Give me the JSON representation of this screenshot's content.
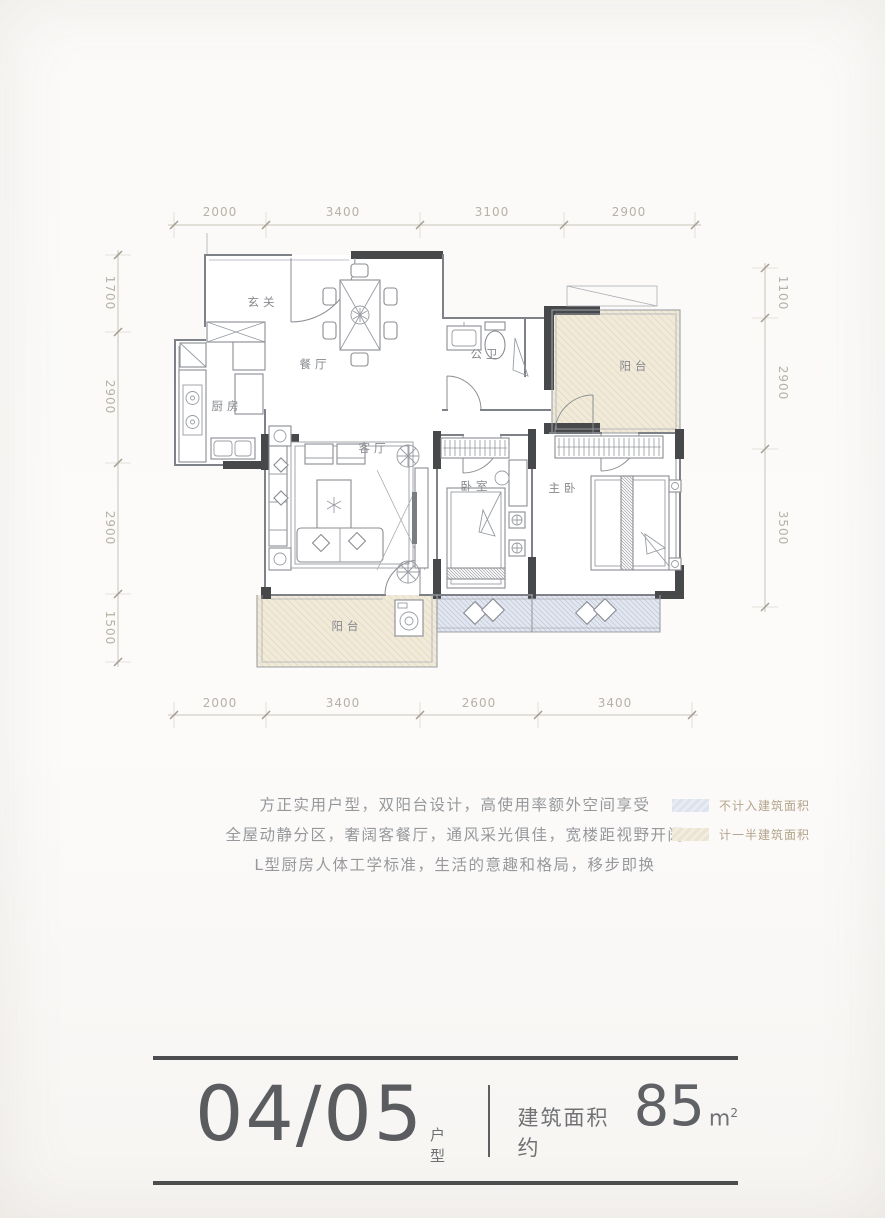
{
  "plan": {
    "dims": {
      "top": [
        "2000",
        "3400",
        "3100",
        "2900"
      ],
      "bottom": [
        "2000",
        "3400",
        "2600",
        "3400"
      ],
      "left": [
        "1700",
        "2900",
        "2900",
        "1500"
      ],
      "right": [
        "1100",
        "2900",
        "3500"
      ]
    },
    "rooms": {
      "entry": "玄关",
      "dining": "餐厅",
      "kitchen": "厨房",
      "bath": "公卫",
      "balcony_top": "阳台",
      "living": "客厅",
      "bedroom": "卧室",
      "master": "主卧",
      "balcony_bottom": "阳台"
    }
  },
  "description": {
    "line1": "方正实用户型，双阳台设计，高使用率额外空间享受",
    "line2": "全屋动静分区，奢阔客餐厅，通风采光俱佳，宽楼距视野开阔",
    "line3": "L型厨房人体工学标准，生活的意趣和格局，移步即换"
  },
  "legend": {
    "items": [
      {
        "label": "不计入建筑面积",
        "color": "#dfe4ee"
      },
      {
        "label": "计一半建筑面积",
        "color": "#efe9da"
      }
    ]
  },
  "footer": {
    "unit_number": "04/05",
    "unit_label": "户型",
    "area_prefix": "建筑面积约",
    "area_value": "85",
    "area_unit": "m",
    "area_sup": "2"
  },
  "colors": {
    "wall_dark": "#46484a",
    "balcony_fill": "#f1ead9",
    "bay_window_fill": "#e2e6ef",
    "dimension_text": "#b7b1a6",
    "legend_text": "#b4a48b",
    "footer_text": "#5a5c5f"
  }
}
